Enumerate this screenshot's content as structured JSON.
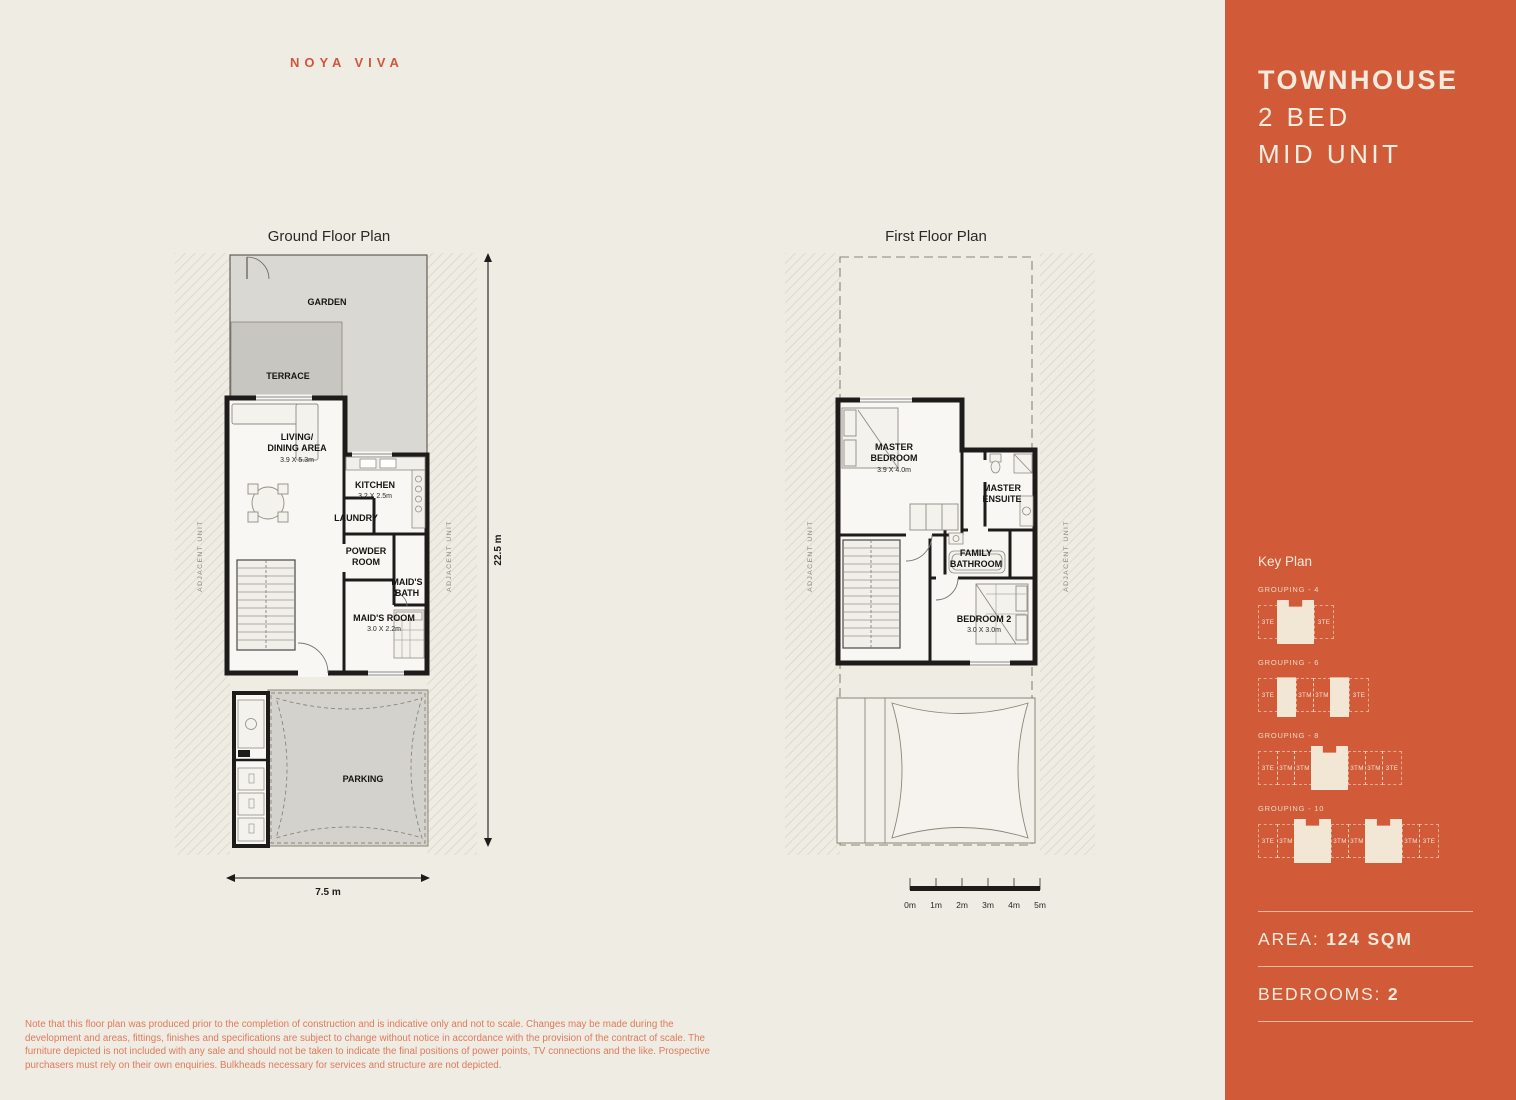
{
  "brand": "NOYA VIVA",
  "colors": {
    "accent": "#D15A38",
    "background": "#EFECE4",
    "cream_text": "#F4EBDC",
    "note_text": "#E07A5C"
  },
  "sidebar": {
    "title_lines": [
      "TOWNHOUSE",
      "2 BED",
      "MID UNIT"
    ],
    "key_plan_title": "Key Plan",
    "groupings": [
      {
        "label": "GROUPING - 4",
        "units": [
          "3TE",
          "3TE"
        ]
      },
      {
        "label": "GROUPING - 6",
        "units": [
          "3TE",
          "3TM",
          "3TM",
          "3TE"
        ]
      },
      {
        "label": "GROUPING - 8",
        "units": [
          "3TE",
          "3TM",
          "3TM",
          "3TM",
          "3TM",
          "3TE"
        ]
      },
      {
        "label": "GROUPING - 10",
        "units": [
          "3TE",
          "3TM",
          "3TM",
          "3TM",
          "3TM",
          "3TE"
        ]
      }
    ],
    "area_label": "AREA:",
    "area_value": "124 SQM",
    "bedrooms_label": "BEDROOMS:",
    "bedrooms_value": "2"
  },
  "ground_floor": {
    "title": "Ground Floor Plan",
    "adjacent_unit_left": "ADJACENT UNIT",
    "adjacent_unit_right": "ADJACENT UNIT",
    "dim_vertical": "22.5 m",
    "dim_horizontal": "7.5 m",
    "labels": {
      "garden": "GARDEN",
      "terrace": "TERRACE",
      "living_1": "LIVING/",
      "living_2": "DINING AREA",
      "living_dim": "3.9 X 5.3m",
      "kitchen": "KITCHEN",
      "kitchen_dim": "3.2 X 2.5m",
      "laundry": "LAUNDRY",
      "powder_1": "POWDER",
      "powder_2": "ROOM",
      "maids_bath_1": "MAID'S",
      "maids_bath_2": "BATH",
      "maids_room": "MAID'S ROOM",
      "maids_room_dim": "3.0 X 2.2m",
      "parking": "PARKING"
    }
  },
  "first_floor": {
    "title": "First Floor Plan",
    "adjacent_unit_left": "ADJACENT UNIT",
    "adjacent_unit_right": "ADJACENT UNIT",
    "labels": {
      "master_1": "MASTER",
      "master_2": "BEDROOM",
      "master_dim": "3.9 X 4.0m",
      "ensuite_1": "MASTER",
      "ensuite_2": "ENSUITE",
      "family_1": "FAMILY",
      "family_2": "BATHROOM",
      "bedroom2": "BEDROOM 2",
      "bedroom2_dim": "3.0 X 3.0m"
    }
  },
  "scale_bar": {
    "ticks": [
      "0m",
      "1m",
      "2m",
      "3m",
      "4m",
      "5m"
    ]
  },
  "footnote": "Note that this floor plan was produced prior to the completion of construction and is indicative only and not to scale. Changes may be made during the development and areas, fittings, finishes and specifications are subject to change without notice in accordance with the provision of the contract of scale. The furniture depicted is not included with any sale and should not be taken to indicate the final positions of power points, TV connections and the like. Prospective purchasers must rely on their own enquiries. Bulkheads necessary for services and structure are not depicted."
}
